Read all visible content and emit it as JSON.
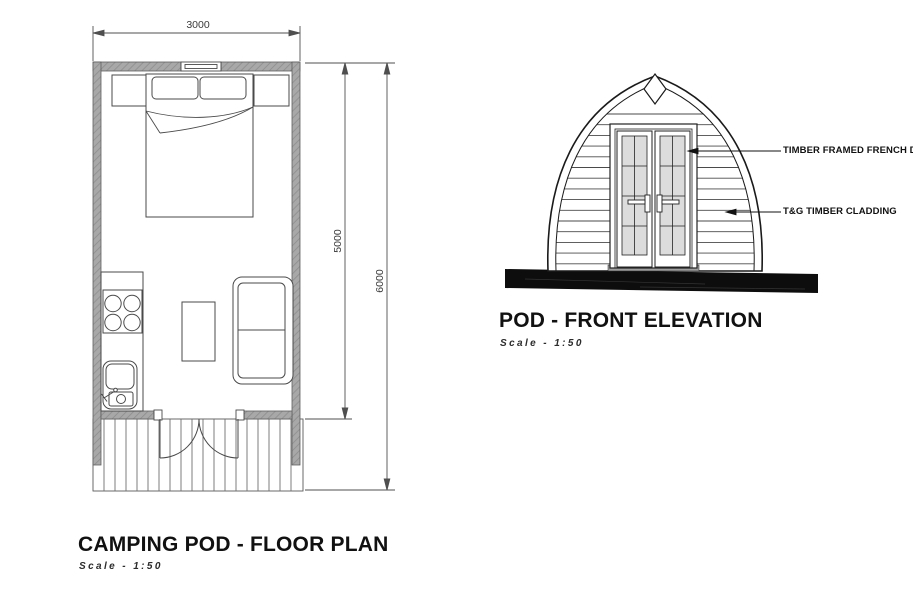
{
  "floor_plan": {
    "title": "CAMPING POD - FLOOR PLAN",
    "scale_label": "Scale - 1:50",
    "dimensions": {
      "width_mm": "3000",
      "pod_length_mm": "5000",
      "total_length_mm": "6000"
    }
  },
  "elevation": {
    "title": "POD - FRONT ELEVATION",
    "scale_label": "Scale - 1:50",
    "annotations": [
      {
        "label": "TIMBER FRAMED FRENCH DOOR"
      },
      {
        "label": "T&G TIMBER CLADDING"
      }
    ]
  },
  "colors": {
    "background": "#ffffff",
    "wall_fill": "#a8a8a8",
    "line": "#1a1a1a",
    "furniture_line": "#4a4a4a",
    "glass_fill": "#dcdcdc",
    "ground_fill": "#0d0d0d"
  }
}
